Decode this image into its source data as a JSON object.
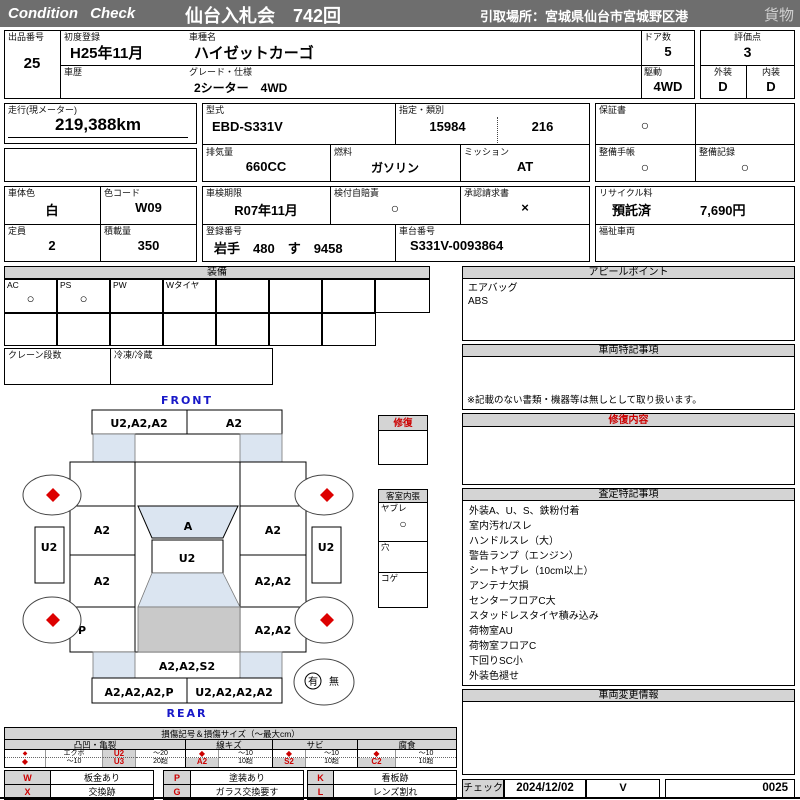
{
  "colors": {
    "header_bg": "#6e6e6e",
    "accent_red": "#cc0000",
    "label_blue": "#1818c8",
    "glass_blue": "#dbe5f1",
    "roof_gray": "#c9c9c9",
    "band_gray": "#d4d4d4"
  },
  "header": {
    "logo": "Condition Check",
    "auction": "仙台入札会　742回",
    "pickup": "引取場所：宮城県仙台市宮城野区港",
    "category": "貨物"
  },
  "info": {
    "lot": {
      "label": "出品番号",
      "value": "25"
    },
    "first_reg": {
      "label": "初度登録",
      "value": "H25年11月"
    },
    "model": {
      "label": "車種名",
      "value": "ハイゼットカーゴ"
    },
    "history": {
      "label": "車歴",
      "value": ""
    },
    "grade": {
      "label": "グレード・仕様",
      "value": "2シーター　4WD"
    },
    "doors": {
      "label": "ドア数",
      "value": "5"
    },
    "drive": {
      "label": "駆動",
      "value": "4WD"
    },
    "score": {
      "label": "評価点",
      "value": "3"
    },
    "exterior": {
      "label": "外装",
      "value": "D"
    },
    "interior": {
      "label": "内装",
      "value": "D"
    },
    "mileage": {
      "label": "走行(現メーター)",
      "value": "219,388km"
    },
    "model_code": {
      "label": "型式",
      "value": "EBD-S331V"
    },
    "type_class": {
      "label": "指定・類別",
      "designation": "15984",
      "classification": "216"
    },
    "warranty": {
      "label": "保証書",
      "value": "○"
    },
    "displacement": {
      "label": "排気量",
      "value": "660CC"
    },
    "fuel": {
      "label": "燃料",
      "value": "ガソリン"
    },
    "mission": {
      "label": "ミッション",
      "value": "AT"
    },
    "maint_book": {
      "label": "整備手帳",
      "value": "○"
    },
    "maint_rec": {
      "label": "整備記録",
      "value": "○"
    },
    "body_color": {
      "label": "車体色",
      "value": "白"
    },
    "color_code": {
      "label": "色コード",
      "value": "W09"
    },
    "inspection": {
      "label": "車検期限",
      "value": "R07年11月"
    },
    "insurance": {
      "label": "検付自賠責",
      "value": "○"
    },
    "approval": {
      "label": "承認請求書",
      "value": "×"
    },
    "recycle": {
      "label": "リサイクル料",
      "status": "預託済",
      "fee": "7,690円"
    },
    "capacity": {
      "label": "定員",
      "value": "2"
    },
    "load": {
      "label": "積載量",
      "value": "350"
    },
    "reg_no": {
      "label": "登録番号",
      "value": "岩手　480　す　9458"
    },
    "chassis": {
      "label": "車台番号",
      "value": "S331V-0093864"
    },
    "welfare": {
      "label": "福祉車両",
      "value": ""
    }
  },
  "equipment": {
    "title": "装備",
    "row1": [
      {
        "label": "AC",
        "mark": "○"
      },
      {
        "label": "PS",
        "mark": "○"
      },
      {
        "label": "PW",
        "mark": ""
      },
      {
        "label": "Wタイヤ",
        "mark": ""
      },
      {
        "label": "",
        "mark": ""
      },
      {
        "label": "",
        "mark": ""
      },
      {
        "label": "",
        "mark": ""
      },
      {
        "label": "",
        "mark": ""
      }
    ],
    "crane_label": "クレーン段数",
    "reefer_label": "冷凍/冷蔵"
  },
  "appeal": {
    "title": "アピールポイント",
    "lines": [
      "エアバッグ",
      "ABS"
    ]
  },
  "special_notes": {
    "title": "車両特記事項",
    "note": "※記載のない書類・機器等は無しとして取り扱います。"
  },
  "repair_content": {
    "title": "修復内容"
  },
  "assessment": {
    "title": "査定特記事項",
    "lines": [
      "外装A、U、S、鉄粉付着",
      "室内汚れ/スレ",
      "ハンドルスレ（大）",
      "警告ランプ（エンジン）",
      "シートヤブレ（10cm以上）",
      "アンテナ欠損",
      "センターフロアC大",
      "スタッドレスタイヤ積み込み",
      "荷物室AU",
      "荷物室フロアC",
      "下回りSC小",
      "外装色褪せ"
    ]
  },
  "change_info": {
    "title": "車両変更情報"
  },
  "check": {
    "label": "チェック",
    "date": "2024/12/02",
    "checker": "V",
    "number": "0025"
  },
  "diagram": {
    "front_label": "FRONT",
    "rear_label": "REAR",
    "repair_box_title": "修復",
    "cabin": {
      "title": "客室内張",
      "rows": [
        {
          "label": "ヤブレ",
          "mark": "○"
        },
        {
          "label": "穴",
          "mark": ""
        },
        {
          "label": "コゲ",
          "mark": ""
        }
      ]
    },
    "spare": {
      "yes": "有",
      "no": "無"
    },
    "panels": {
      "front_bumper_left": "U2,A2,A2",
      "front_bumper_right": "A2",
      "windshield": "A",
      "hood": "U2",
      "left_side_panel": "U2",
      "right_side_panel": "U2",
      "left_front_door": "A2",
      "left_rear_door": "A2",
      "left_quarter": "P",
      "right_front_door": "A2",
      "right_rear_door": "A2,A2",
      "right_quarter": "A2,A2",
      "tailgate": "A2,A2,S2",
      "rear_bumper_left": "A2,A2,A2,P",
      "rear_bumper_right": "U2,A2,A2,A2"
    }
  },
  "legend": {
    "title": "損傷記号＆損傷サイズ（～最大cm）",
    "groups": [
      {
        "name": "凸凹・亀裂",
        "r1": [
          "◆",
          "エクボ",
          "U2",
          "～20"
        ],
        "r2": [
          "◆",
          "～10",
          "U3",
          "20超"
        ]
      },
      {
        "name": "線キズ",
        "r1": [
          "◆",
          "～10"
        ],
        "r2": [
          "A2",
          "10超"
        ]
      },
      {
        "name": "サビ",
        "r1": [
          "◆",
          "～10"
        ],
        "r2": [
          "S2",
          "10超"
        ]
      },
      {
        "name": "腐食",
        "r1": [
          "◆",
          "～10"
        ],
        "r2": [
          "C2",
          "10超"
        ]
      }
    ],
    "codes": {
      "w": {
        "code": "W",
        "desc": "板金あり"
      },
      "p": {
        "code": "P",
        "desc": "塗装あり"
      },
      "k": {
        "code": "K",
        "desc": "看板跡"
      },
      "x": {
        "code": "X",
        "desc": "交換跡"
      },
      "g": {
        "code": "G",
        "desc": "ガラス交換要す"
      },
      "l": {
        "code": "L",
        "desc": "レンズ割れ"
      }
    }
  }
}
